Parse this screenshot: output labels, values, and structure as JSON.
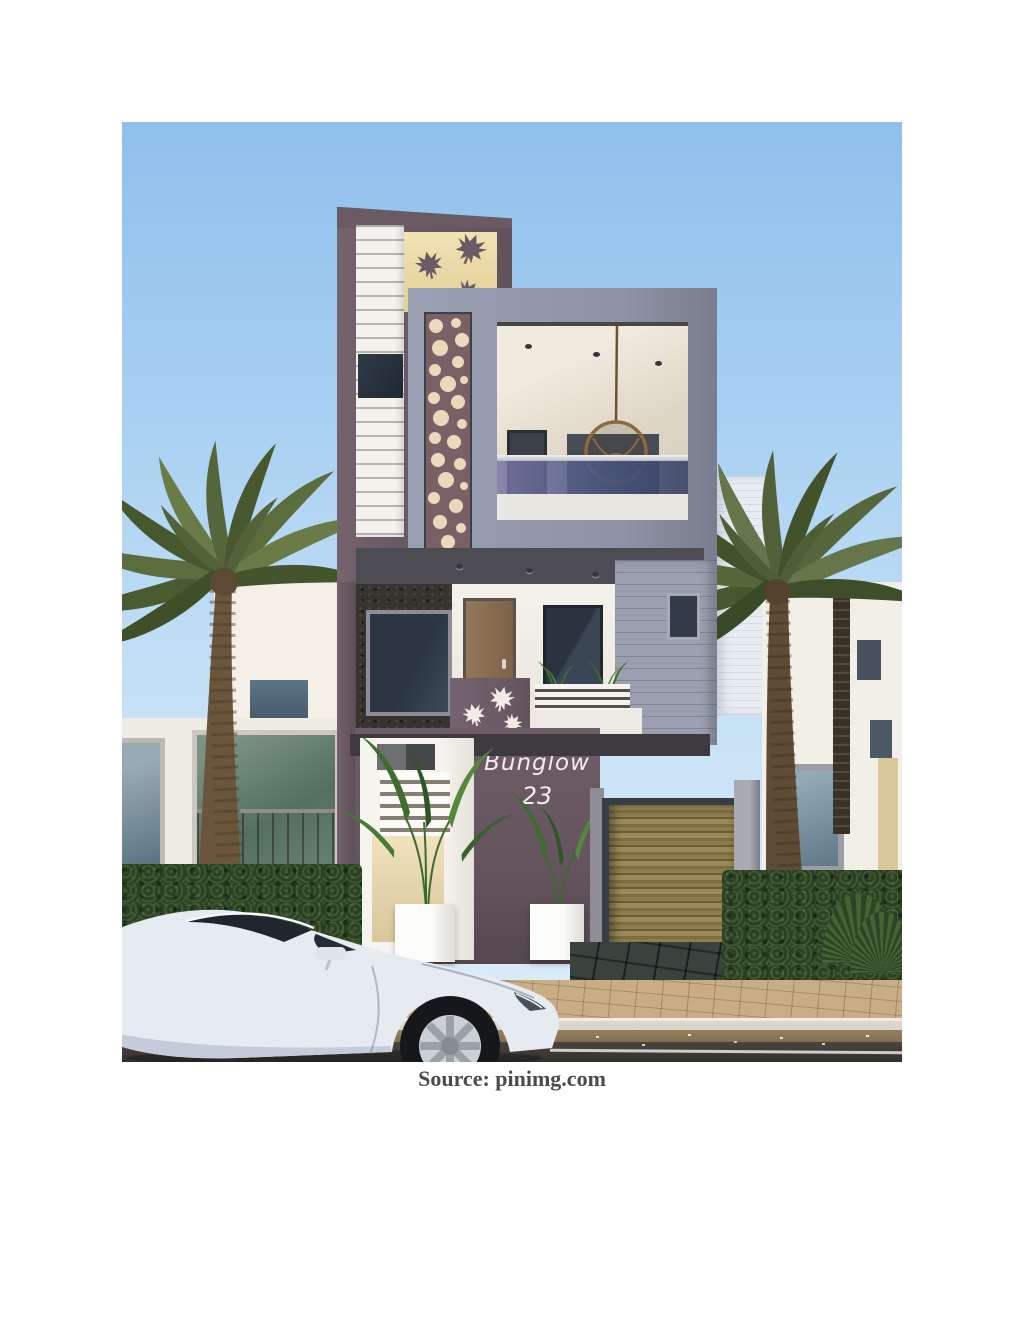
{
  "page": {
    "background_color": "#ffffff",
    "caption": "Source: pinimg.com"
  },
  "scene": {
    "type": "architectural-rendering",
    "description": "3D exterior render of a narrow modern two-storey bungalow in mauve, grey and white, with maple-leaf wall decals, a decorative lattice panel, an upper balcony with a hanging rattan egg chair, a bamboo entrance gate, potted plants, flanking date palm trees, a green hedge, background white villas, and a white sports car parked on the street in front.",
    "sign": {
      "line1": "Bunglow",
      "line2": "23"
    },
    "colors": {
      "sky": "#9cc5ee",
      "mauve_wall": "#6a5a64",
      "gray_block": "#8d92a4",
      "cream_panel": "#ecdcab",
      "white_wall": "#f2efe8",
      "stone_wall": "#37332e",
      "bamboo_gate": "#8d7d4c",
      "hedge": "#324726",
      "palm_foliage": "#57683a",
      "road": "#45403a",
      "paver": "#c9ae85",
      "car_body": "#e6ebf2"
    }
  }
}
